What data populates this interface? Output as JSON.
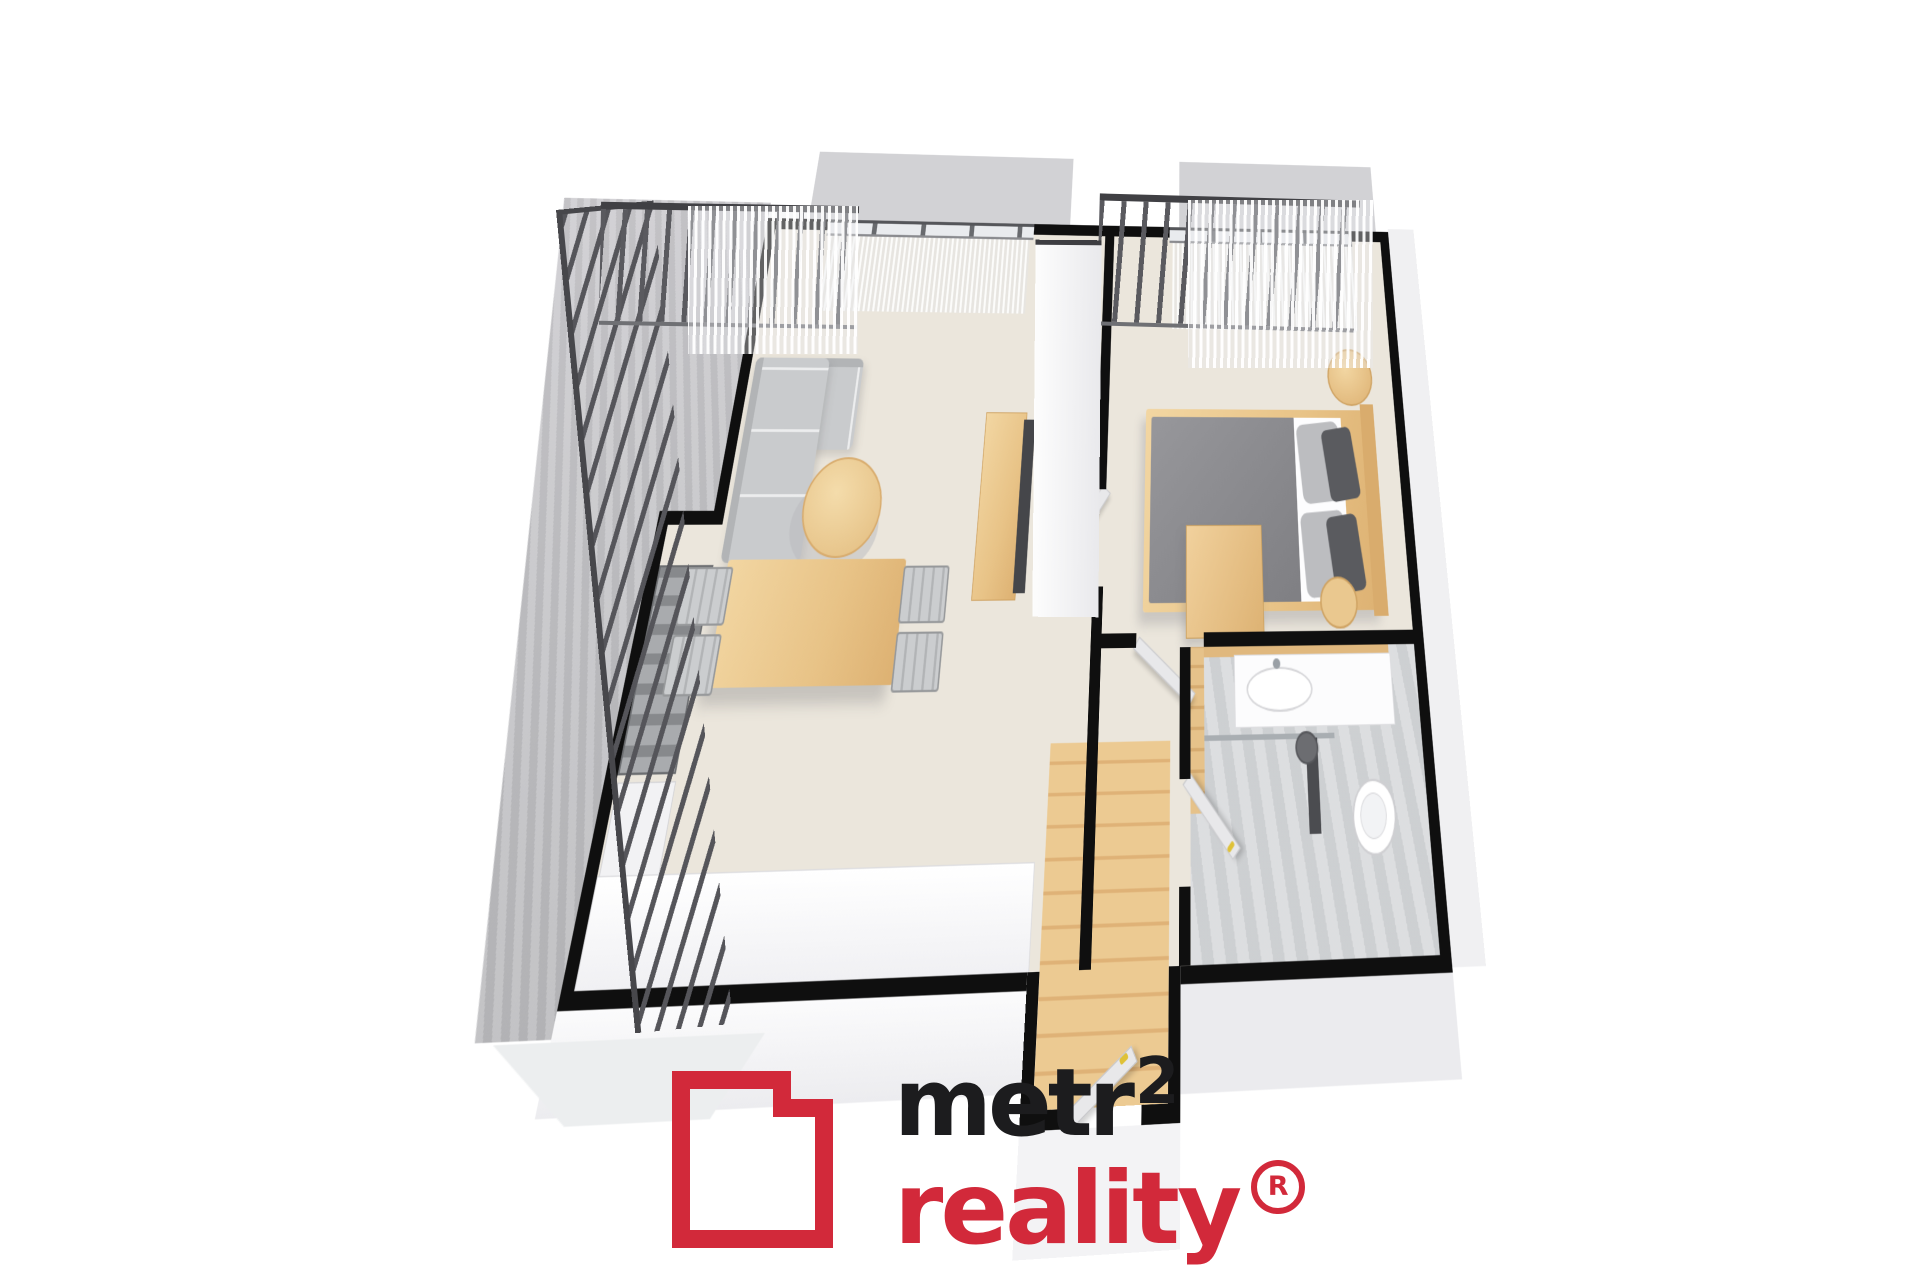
{
  "logo": {
    "wordmark": "metr",
    "superscript": "2",
    "line2": "reality",
    "registered": "®",
    "colors": {
      "red": "#d2293a",
      "black": "#1c1c1e"
    }
  },
  "palette": {
    "background": "#ffffff",
    "wall_outline": "#0f0f0f",
    "interior_floor": "#ebe6dc",
    "bathroom_floor": "#d6d8da",
    "balcony_concrete": "#c6c6c9",
    "railing": "#4a4a4f",
    "wood_furniture": "#eac88f",
    "sofa_gray": "#c9cbcd",
    "bed_duvet_gray": "#8a8b8e",
    "door_leaf": "#e8e8ea",
    "door_handle_yellow": "#dfc137",
    "tv_panel": "#45464a"
  },
  "floorplan": {
    "view": "3d-perspective-floor-plan",
    "rooms": [
      {
        "name": "balcony-terrace",
        "features": [
          "bar-railing",
          "concrete-floor"
        ]
      },
      {
        "name": "living-room",
        "furniture": [
          "corner-sofa",
          "round-coffee-table",
          "dining-table",
          "four-chairs",
          "shelving-unit",
          "kitchen-counter",
          "tv-stand"
        ]
      },
      {
        "name": "bedroom",
        "furniture": [
          "double-bed",
          "gray-duvet",
          "pillows",
          "wood-headboard",
          "round-bedside-table",
          "dresser",
          "stool"
        ]
      },
      {
        "name": "bathroom",
        "furniture": [
          "washbasin-vanity",
          "shower-glass",
          "shower-column",
          "toilet",
          "wood-accent-wall"
        ]
      },
      {
        "name": "hallway-entry",
        "furniture": [
          "open-doors",
          "wood-flooring"
        ]
      }
    ]
  }
}
